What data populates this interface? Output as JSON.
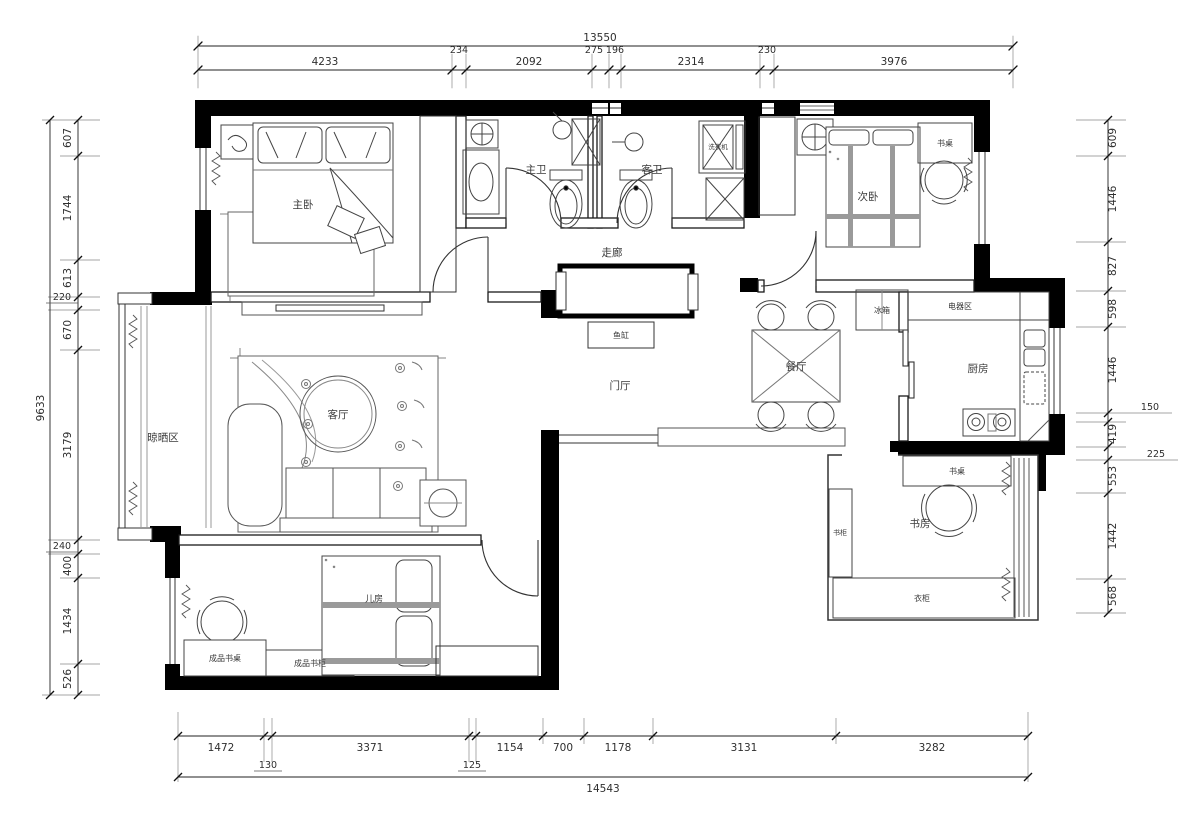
{
  "drawing": {
    "bg_color": "#ffffff",
    "wall_color": "#000000",
    "line_color": "#2e2e2e"
  },
  "dimensions": {
    "top": {
      "overall": "13550",
      "segments": [
        "4233",
        "234",
        "2092",
        "275",
        "196",
        "2314",
        "230",
        "3976"
      ]
    },
    "bottom": {
      "overall": "14543",
      "segments": [
        "1472",
        "130",
        "3371",
        "125",
        "1154",
        "700",
        "1178",
        "3131",
        "3282"
      ]
    },
    "left": {
      "overall": "9633",
      "segments": [
        "607",
        "1744",
        "613",
        "220",
        "670",
        "3179",
        "240",
        "400",
        "1434",
        "526"
      ]
    },
    "right": {
      "segments": [
        "609",
        "1446",
        "827",
        "598",
        "1446",
        "150",
        "419",
        "225",
        "553",
        "1442",
        "568"
      ]
    }
  },
  "rooms": {
    "master_bedroom": {
      "label": "主卧"
    },
    "master_bath": {
      "label": "主卫"
    },
    "guest_bath": {
      "label": "客卫"
    },
    "corridor": {
      "label": "走廊"
    },
    "second_bedroom": {
      "label": "次卧"
    },
    "kitchen": {
      "label": "厨房"
    },
    "dining_room": {
      "label": "餐厅"
    },
    "foyer": {
      "label": "门厅"
    },
    "living_room": {
      "label": "客厅"
    },
    "drying_area": {
      "label": "晾晒区"
    },
    "kids_room": {
      "label": "儿房"
    },
    "study": {
      "label": "书房"
    }
  },
  "furniture": {
    "fish_tank": "鱼缸",
    "fridge": "冰箱",
    "appliance_area": "电器区",
    "washing_machine": "洗衣机",
    "desk_second_bedroom": "书桌",
    "desk_study": "书桌",
    "bookcase_study": "书柜",
    "wardrobe_study": "衣柜",
    "kids_desk": "成品书桌",
    "kids_bookcase": "成品书柜"
  }
}
